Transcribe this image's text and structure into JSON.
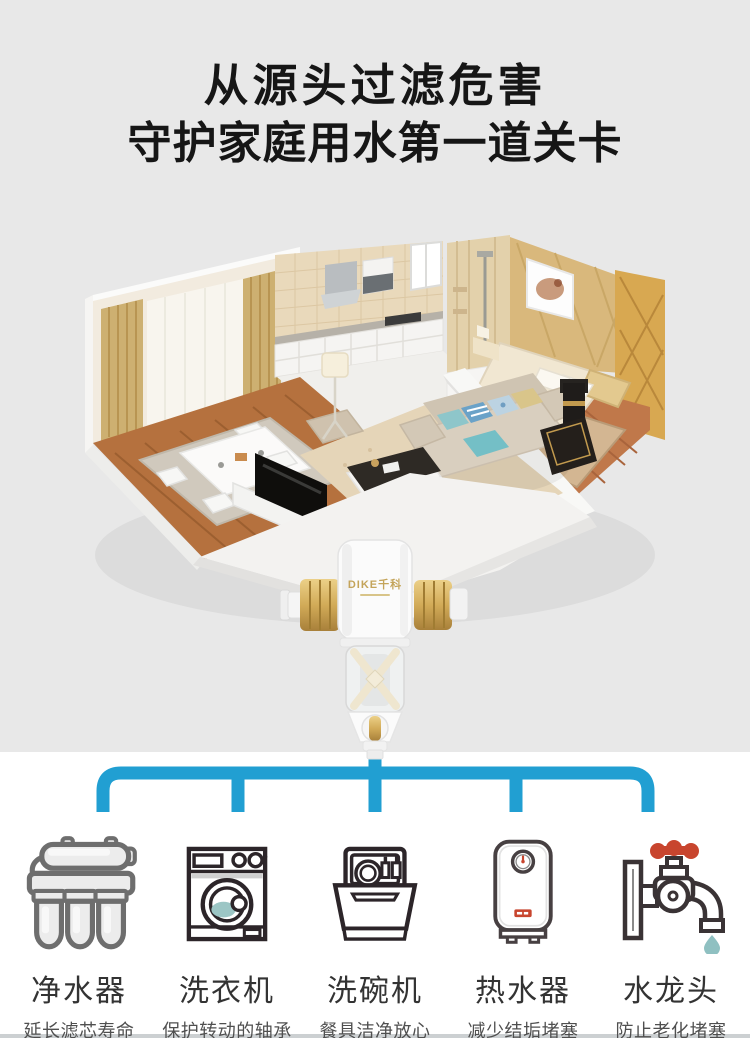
{
  "page": {
    "background_top": "#e8e8e8",
    "background_bottom": "#ffffff",
    "accent_blue": "#219fd2",
    "divider_gray": "#ccd0d2"
  },
  "title": {
    "line1": "从源头过滤危害",
    "line2": "守护家庭用水第一道关卡"
  },
  "product": {
    "brand": "DIKE千科",
    "body_color": "#fbfbfb",
    "fitting_gold": "#d2ab58"
  },
  "connector": {
    "color": "#219fd2",
    "branches": 5
  },
  "appliances": [
    {
      "name": "净水器",
      "desc": "延长滤芯寿命",
      "icon": "water-purifier-icon"
    },
    {
      "name": "洗衣机",
      "desc": "保护转动的轴承",
      "icon": "washing-machine-icon"
    },
    {
      "name": "洗碗机",
      "desc": "餐具洁净放心",
      "icon": "dishwasher-icon"
    },
    {
      "name": "热水器",
      "desc": "减少结垢堵塞",
      "icon": "water-heater-icon"
    },
    {
      "name": "水龙头",
      "desc": "防止老化堵塞",
      "icon": "faucet-icon"
    }
  ],
  "icon_colors": {
    "outline_dark": "#2c2529",
    "outline_gray": "#6e6e6e",
    "teal": "#9cc6c5",
    "red": "#c8452e"
  }
}
